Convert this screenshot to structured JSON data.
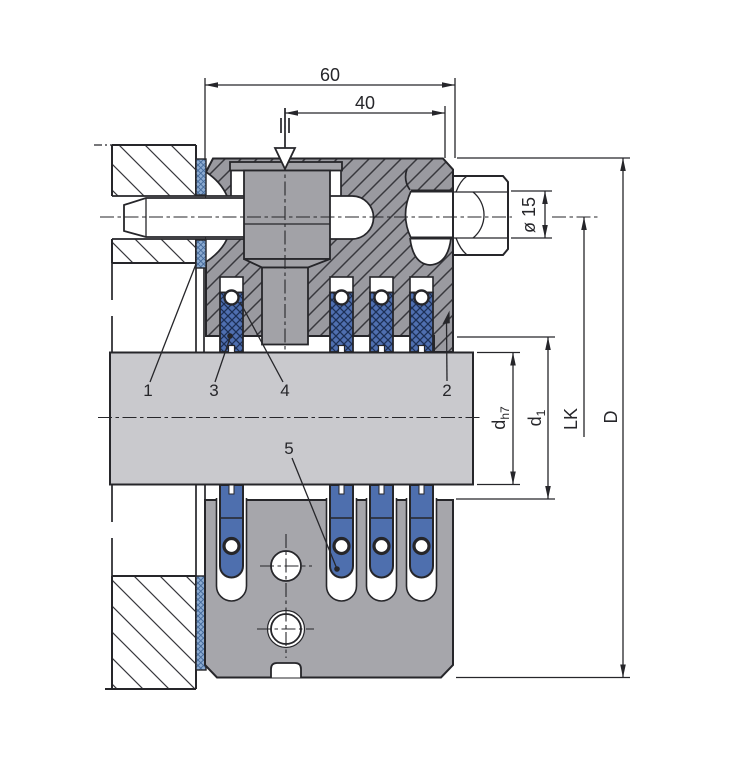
{
  "drawing": {
    "type": "technical-cross-section",
    "description": "Stuffing box / shaft packing gland assembly section view with grease injection screw"
  },
  "dims": {
    "total_width": "60",
    "screw_offset": "40",
    "bolt_diameter": "ø 15",
    "shaft_d": "d",
    "shaft_d_sub": "h7",
    "bore_d": "d",
    "bore_d_sub": "1",
    "bolt_circle": "LK",
    "outer_diameter": "D"
  },
  "callouts": {
    "n1": "1",
    "n2": "2",
    "n3": "3",
    "n4": "4",
    "n5": "5"
  },
  "packing": {
    "ring_centers_x": [
      231.5,
      341.5,
      381.5,
      421.5
    ],
    "tongue_centers_x": [
      231.5,
      341.5,
      381.5,
      421.5
    ]
  },
  "colors": {
    "line": "#26262a",
    "body-gray": "#9a9aa0",
    "hatch-line": "#38383d",
    "screw-gray": "#a2a2a7",
    "shaft-gray": "#c9c9cd",
    "plate-gray": "#a6a6ab",
    "ring-blue": "#4f6fb0",
    "ring-line": "#1c2f55",
    "gasket-blue": "#8cabd1",
    "gasket-line": "#44699a",
    "tongue-blue": "#4e6fae"
  }
}
